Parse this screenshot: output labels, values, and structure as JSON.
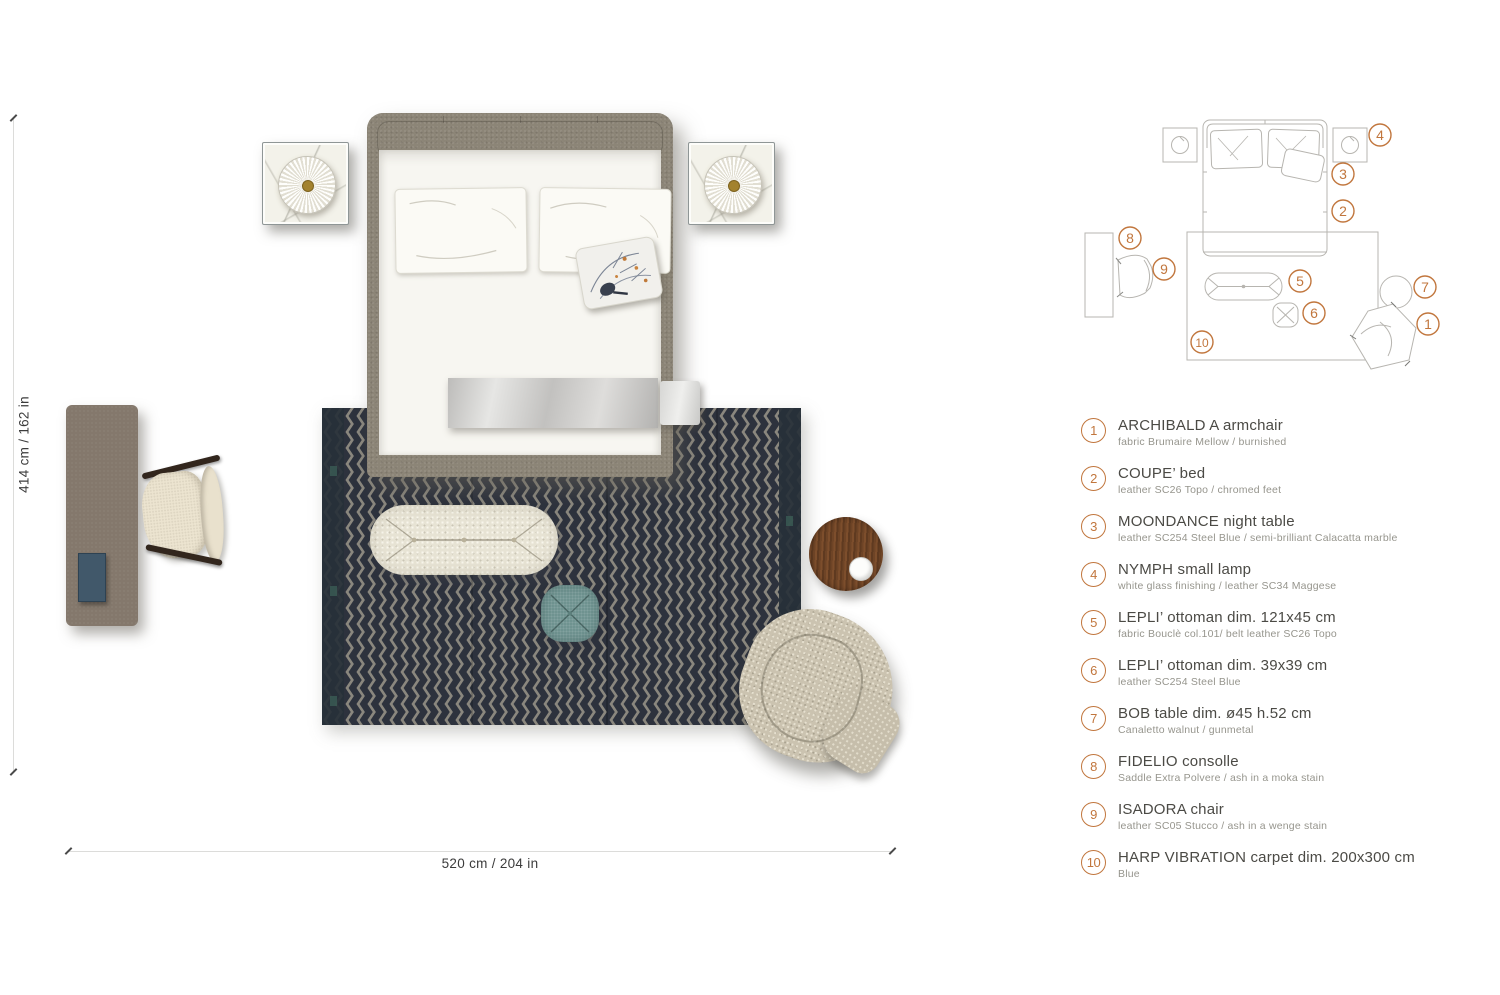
{
  "dimensions": {
    "vertical_label": "414 cm / 162 in",
    "horizontal_label": "520 cm / 204 in"
  },
  "legend": {
    "items": [
      {
        "number": "1",
        "title": "ARCHIBALD A armchair",
        "subtitle": "fabric Brumaire Mellow / burnished"
      },
      {
        "number": "2",
        "title": "COUPE’ bed",
        "subtitle": "leather SC26 Topo / chromed feet"
      },
      {
        "number": "3",
        "title": "MOONDANCE night table",
        "subtitle": "leather SC254 Steel Blue / semi-brilliant Calacatta marble"
      },
      {
        "number": "4",
        "title": "NYMPH small lamp",
        "subtitle": "white glass finishing / leather SC34 Maggese"
      },
      {
        "number": "5",
        "title": "LEPLI’ ottoman dim. 121x45 cm",
        "subtitle": "fabric Bouclè col.101/ belt leather SC26 Topo"
      },
      {
        "number": "6",
        "title": "LEPLI’ ottoman dim. 39x39 cm",
        "subtitle": "leather SC254 Steel Blue"
      },
      {
        "number": "7",
        "title": "BOB table dim. ø45 h.52 cm",
        "subtitle": "Canaletto walnut / gunmetal"
      },
      {
        "number": "8",
        "title": "FIDELIO consolle",
        "subtitle": "Saddle Extra Polvere / ash in a moka stain"
      },
      {
        "number": "9",
        "title": "ISADORA chair",
        "subtitle": "leather SC05 Stucco / ash in a wenge stain"
      },
      {
        "number": "10",
        "title": "HARP VIBRATION carpet dim. 200x300 cm",
        "subtitle": "Blue"
      }
    ]
  },
  "plan": {
    "markers": [
      "1",
      "2",
      "3",
      "4",
      "5",
      "6",
      "7",
      "8",
      "9",
      "10"
    ]
  },
  "colors": {
    "accent": "#c1763d",
    "carpet_base": "#2d323d",
    "carpet_weave": "#9a978a",
    "carpet_border": "#273038",
    "bed_frame_taupe": "#8c8577",
    "bedding_white": "#f7f6f1",
    "marble_white": "#f3f2ea",
    "steel_blue": "#41586a",
    "teal_ottoman": "#6f9390",
    "walnut": "#6e4426",
    "console_taupe": "#84786c",
    "cream_boucle": "#e7e3d4",
    "greige_tweed": "#cbc3b0",
    "wenge": "#32261d",
    "legend_title_gray": "#4b4a45",
    "legend_sub_gray": "#96958d",
    "plan_line_gray": "#b7b5b0"
  }
}
